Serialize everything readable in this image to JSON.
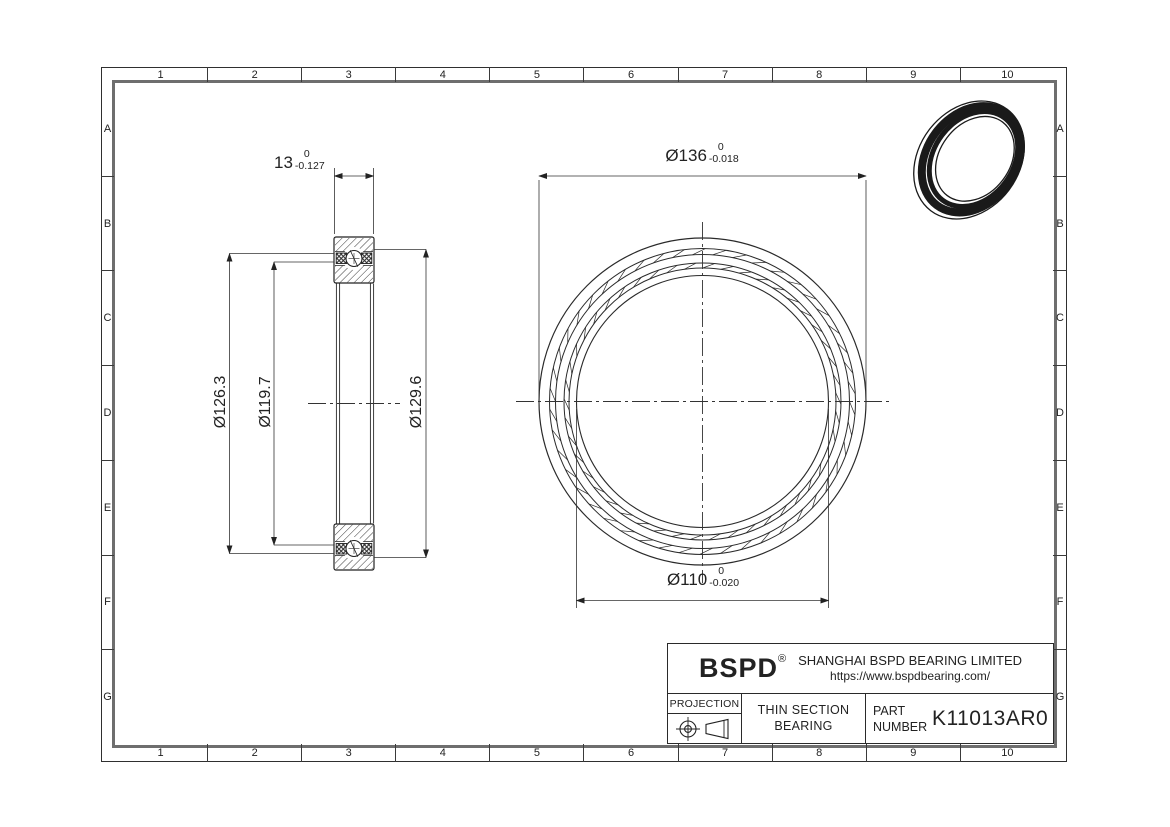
{
  "sheet": {
    "grid_columns": [
      "1",
      "2",
      "3",
      "4",
      "5",
      "6",
      "7",
      "8",
      "9",
      "10"
    ],
    "grid_rows": [
      "A",
      "B",
      "C",
      "D",
      "E",
      "F",
      "G"
    ]
  },
  "side_view": {
    "width_dim": {
      "value": "13",
      "tol_upper": "0",
      "tol_lower": "-0.127"
    },
    "outer_race_dim": "Ø126.3",
    "inner_race_dim": "Ø119.7",
    "pitch_dim": "Ø129.6"
  },
  "front_view": {
    "outer_diameter_dim": {
      "value": "Ø136",
      "tol_upper": "0",
      "tol_lower": "-0.018"
    },
    "bore_diameter_dim": {
      "value": "Ø110",
      "tol_upper": "0",
      "tol_lower": "-0.020"
    }
  },
  "title_block": {
    "logo_text": "BSPD",
    "registered_mark": "®",
    "company_name": "SHANGHAI BSPD BEARING LIMITED",
    "website": "https://www.bspdbearing.com/",
    "projection_label": "PROJECTION",
    "product_type_line1": "THIN SECTION",
    "product_type_line2": "BEARING",
    "part_number_label_line1": "PART",
    "part_number_label_line2": "NUMBER",
    "part_number": "K11013AR0"
  },
  "colors": {
    "line": "#222222",
    "thick_border": "#6e6e6e",
    "background": "#ffffff"
  }
}
